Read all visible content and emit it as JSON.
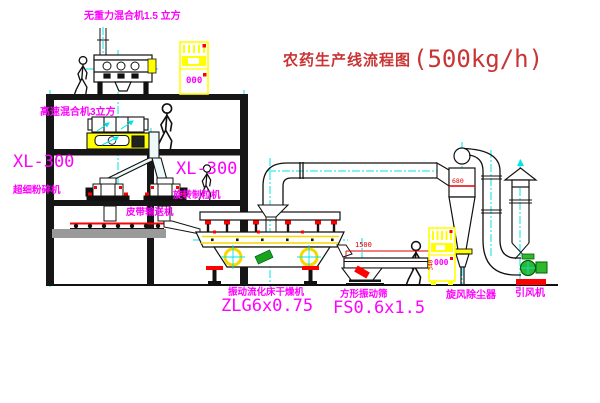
{
  "title": {
    "text": "农药生产线流程图",
    "capacity": "(500kg/h)"
  },
  "labels": {
    "top_mixer": "无重力混合机1.5 立方",
    "hs_mixer": "高速混合机3立方",
    "xl300_left": "XL-300",
    "mill": "超细粉碎机",
    "xl300_right": "XL-300",
    "granulator": "旋转制粒机",
    "belt": "皮带输送机",
    "dryer": "振动流化床干燥机",
    "dryer_model": "ZLG6x0.75",
    "sieve": "方形振动筛",
    "sieve_model": "FS0.6x1.5",
    "cyclone": "旋风除尘器",
    "fan": "引风机"
  },
  "dimensions": {
    "sieve_length": "1500",
    "sieve_height": "340",
    "cyclone_band": "680"
  },
  "panels": {
    "panel1": "000",
    "panel2": "000"
  },
  "colors": {
    "label_magenta": "#FF00FF",
    "title_red": "#C93434",
    "dim_red": "#E00000",
    "equipment_yellow": "#FFFF00",
    "centerline_cyan": "#00FFFF",
    "fan_green": "#2EB82E",
    "line_black": "#111111"
  }
}
